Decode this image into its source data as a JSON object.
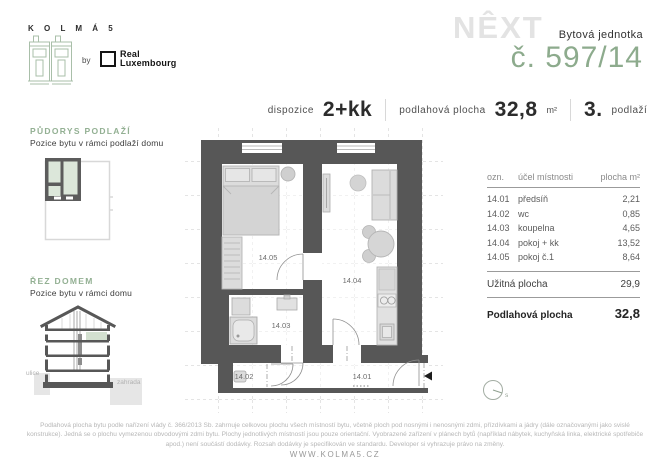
{
  "brand": {
    "kolma_logo_text": "K O L M Á  5",
    "by_label": "by",
    "partner_line1": "Real",
    "partner_line2": "Luxembourg",
    "next_logo": "NÊXT",
    "unit_type_label": "Bytová jednotka",
    "unit_number": "č. 597/14"
  },
  "specs": {
    "dispozice_label": "dispozice",
    "dispozice_value": "2+kk",
    "area_label": "podlahová plocha",
    "area_value": "32,8",
    "area_unit": "m²",
    "floor_value": "3.",
    "floor_label": "podlaží"
  },
  "sidebar": {
    "floorplan": {
      "title": "PŮDORYS PODLAŽÍ",
      "subtitle": "Pozice bytu v rámci podlaží domu"
    },
    "section": {
      "title": "ŘEZ DOMEM",
      "subtitle": "Pozice bytu v rámci domu",
      "street_label": "ulice",
      "garden_label": "zahrada"
    }
  },
  "floor_plan": {
    "room_labels": [
      "14.05",
      "14.04",
      "14.03",
      "14.02",
      "14.01"
    ],
    "compass_label": "s"
  },
  "area_table": {
    "headers": [
      "ozn.",
      "účel místnosti",
      "plocha m²"
    ],
    "rows": [
      {
        "id": "14.01",
        "name": "předsíň",
        "area": "2,21"
      },
      {
        "id": "14.02",
        "name": "wc",
        "area": "0,85"
      },
      {
        "id": "14.03",
        "name": "koupelna",
        "area": "4,65"
      },
      {
        "id": "14.04",
        "name": "pokoj + kk",
        "area": "13,52"
      },
      {
        "id": "14.05",
        "name": "pokoj č.1",
        "area": "8,64"
      }
    ],
    "usable_label": "Užitná plocha",
    "usable_value": "29,9",
    "total_label": "Podlahová plocha",
    "total_value": "32,8"
  },
  "footer": {
    "disclaimer": "Podlahová plocha bytu podle nařízení vlády č. 366/2013 Sb. zahrnuje celkovou plochu všech místností bytu, včetně ploch pod nosnými i nenosnými zdmi, přízdívkami a jádry (dále označovanými jako svislé konstrukce). Jedná se o plochu vymezenou obvodovými zdmi bytu. Plochy jednotlivých místností jsou pouze orientační. Vyobrazené zařízení v plánech bytů (například nábytek, kuchyňská linka, elektrické spotřebiče apod.) není součástí dodávky. Rozsah dodávky je specifikován ve standardu. Developer si vyhrazuje právo na změny.",
    "website": "WWW.KOLMA5.CZ"
  },
  "colors": {
    "accent_green": "#8dab8d",
    "highlight_green": "#dce7da",
    "wall_gray": "#575757",
    "furniture_gray": "#d9d9d9",
    "watermark_gray": "#e3e3e3"
  }
}
